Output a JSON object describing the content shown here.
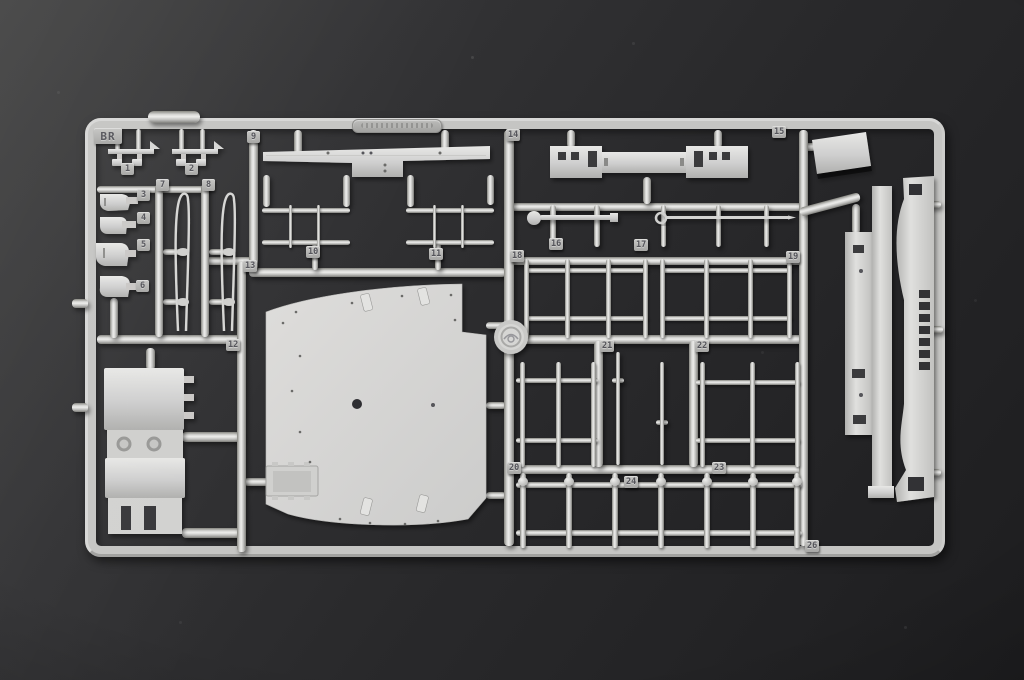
{
  "colors": {
    "background_top": "#3e3e3e",
    "background_bottom": "#1b1b1d",
    "plastic_light": "#ececea",
    "plastic_mid": "#c8c8c6",
    "plastic_dark": "#7b7b77",
    "tab_number": "#54545a"
  },
  "sprue": {
    "code_label": "BR",
    "part_tabs": [
      {
        "label": "1",
        "x": 121,
        "y": 163
      },
      {
        "label": "2",
        "x": 185,
        "y": 163
      },
      {
        "label": "7",
        "x": 156,
        "y": 179
      },
      {
        "label": "8",
        "x": 202,
        "y": 179
      },
      {
        "label": "3",
        "x": 137,
        "y": 189
      },
      {
        "label": "4",
        "x": 137,
        "y": 212
      },
      {
        "label": "5",
        "x": 137,
        "y": 239
      },
      {
        "label": "6",
        "x": 136,
        "y": 280
      },
      {
        "label": "9",
        "x": 247,
        "y": 131
      },
      {
        "label": "10",
        "x": 306,
        "y": 246
      },
      {
        "label": "11",
        "x": 429,
        "y": 248
      },
      {
        "label": "12",
        "x": 226,
        "y": 339
      },
      {
        "label": "13",
        "x": 243,
        "y": 260
      },
      {
        "label": "14",
        "x": 506,
        "y": 129
      },
      {
        "label": "15",
        "x": 772,
        "y": 126
      },
      {
        "label": "16",
        "x": 549,
        "y": 238
      },
      {
        "label": "17",
        "x": 634,
        "y": 239
      },
      {
        "label": "18",
        "x": 510,
        "y": 250
      },
      {
        "label": "19",
        "x": 786,
        "y": 251
      },
      {
        "label": "20",
        "x": 507,
        "y": 462
      },
      {
        "label": "21",
        "x": 600,
        "y": 340
      },
      {
        "label": "22",
        "x": 695,
        "y": 340
      },
      {
        "label": "23",
        "x": 712,
        "y": 462
      },
      {
        "label": "24",
        "x": 624,
        "y": 476
      },
      {
        "label": "26",
        "x": 805,
        "y": 540
      }
    ]
  }
}
